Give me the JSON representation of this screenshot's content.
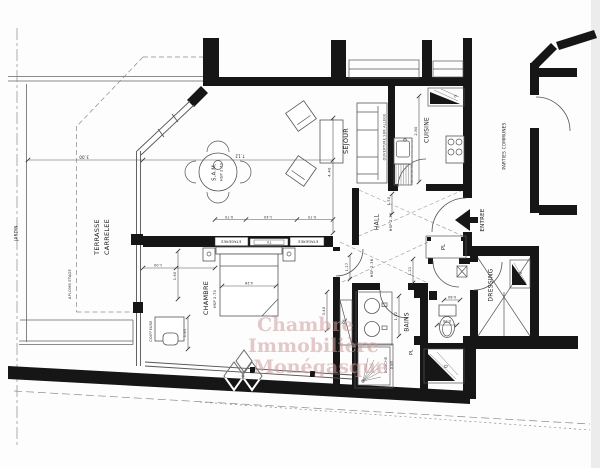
{
  "plan": {
    "rooms": {
      "jardin": "JARDIN",
      "terrasse_1": "TERRASSE",
      "terrasse_2": "CARRELEE",
      "aplomb": "APLOMB ETAGE",
      "sam": "S.A.M.",
      "hsp270": "HSP 2.70",
      "hsp236": "HSP 2.36",
      "sejour": "SEJOUR",
      "ouverture": "OUVERTURE SUR ALLEGE",
      "cuisine": "CUISINE",
      "hall": "HALL",
      "entree": "ENTREE",
      "parties_communes": "PARTIES COMMUNES",
      "pl": "PL",
      "chambre": "CHAMBRE",
      "coiffeuse": "COIFFEUSE",
      "bains": "BAINS",
      "douche": "DOUCHE",
      "dressing": "DRESSING",
      "etageres": "ETAGERES",
      "tv": "TV",
      "gaine": "G"
    },
    "dims": {
      "v300": "3.00",
      "v712": "7.12",
      "v440": "4.40",
      "v280": "2.80",
      "v150": "1.50",
      "v070": "0.70",
      "v140": "1.40",
      "v100": "1.00",
      "v160": "1.60",
      "v145": "1.45",
      "v426": "4.26",
      "v127": "1.27",
      "v121": "1.21",
      "v340": "3.40",
      "v152": "1.52",
      "v090": "0.90",
      "v060": "0.60",
      "v080": "0.80"
    }
  },
  "watermark": {
    "line1": "Chambre",
    "line2": "Immobilière",
    "line3": "Monégasque",
    "color": "#cf9d9d"
  }
}
